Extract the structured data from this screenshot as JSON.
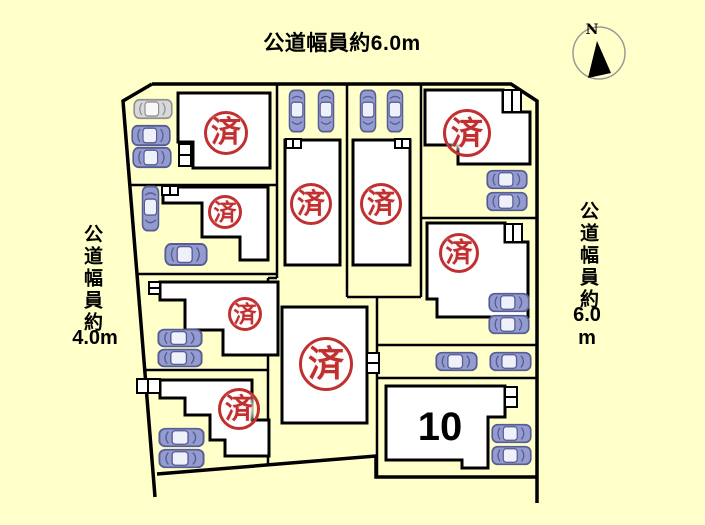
{
  "title": "分譲区画図",
  "roads": {
    "top": {
      "label": "公道幅員約6.0m"
    },
    "left": {
      "label_vertical": "公道幅員約",
      "width_label": "4.0m"
    },
    "right": {
      "label_vertical": "公道幅員約",
      "width_value": "6.0",
      "width_unit": "m"
    }
  },
  "compass": {
    "label": "N"
  },
  "available_lot": {
    "number": "10"
  },
  "sold_stamps": {
    "char": "済",
    "positions": [
      {
        "lot": "1",
        "cx": 226,
        "cy": 133,
        "r": 22
      },
      {
        "lot": "2",
        "cx": 225,
        "cy": 212,
        "r": 17
      },
      {
        "lot": "3",
        "cx": 245,
        "cy": 314,
        "r": 17
      },
      {
        "lot": "4",
        "cx": 239,
        "cy": 409,
        "r": 21
      },
      {
        "lot": "5",
        "cx": 311,
        "cy": 204,
        "r": 21
      },
      {
        "lot": "6",
        "cx": 381,
        "cy": 204,
        "r": 21
      },
      {
        "lot": "7",
        "cx": 326,
        "cy": 364,
        "r": 27
      },
      {
        "lot": "8",
        "cx": 467,
        "cy": 133,
        "r": 24
      },
      {
        "lot": "9",
        "cx": 459,
        "cy": 253,
        "r": 20
      }
    ]
  },
  "cars": [
    {
      "x": 133,
      "y": 98,
      "w": 40,
      "h": 22,
      "dir": "h",
      "variant": "gray"
    },
    {
      "x": 131,
      "y": 124,
      "w": 40,
      "h": 23,
      "dir": "h",
      "variant": "blue"
    },
    {
      "x": 132,
      "y": 146,
      "w": 40,
      "h": 23,
      "dir": "h",
      "variant": "blue"
    },
    {
      "x": 141,
      "y": 185,
      "w": 19,
      "h": 47,
      "dir": "v",
      "variant": "blue"
    },
    {
      "x": 164,
      "y": 242,
      "w": 44,
      "h": 25,
      "dir": "h",
      "variant": "blue"
    },
    {
      "x": 157,
      "y": 328,
      "w": 46,
      "h": 20,
      "dir": "h",
      "variant": "blue"
    },
    {
      "x": 157,
      "y": 348,
      "w": 46,
      "h": 20,
      "dir": "h",
      "variant": "blue"
    },
    {
      "x": 158,
      "y": 427,
      "w": 47,
      "h": 21,
      "dir": "h",
      "variant": "blue"
    },
    {
      "x": 158,
      "y": 448,
      "w": 47,
      "h": 21,
      "dir": "h",
      "variant": "blue"
    },
    {
      "x": 288,
      "y": 89,
      "w": 18,
      "h": 44,
      "dir": "v",
      "variant": "blue"
    },
    {
      "x": 317,
      "y": 89,
      "w": 18,
      "h": 44,
      "dir": "v",
      "variant": "blue"
    },
    {
      "x": 359,
      "y": 89,
      "w": 18,
      "h": 44,
      "dir": "v",
      "variant": "blue"
    },
    {
      "x": 386,
      "y": 89,
      "w": 18,
      "h": 44,
      "dir": "v",
      "variant": "blue"
    },
    {
      "x": 486,
      "y": 169,
      "w": 42,
      "h": 21,
      "dir": "h",
      "variant": "blue"
    },
    {
      "x": 486,
      "y": 191,
      "w": 42,
      "h": 21,
      "dir": "h",
      "variant": "blue"
    },
    {
      "x": 488,
      "y": 292,
      "w": 42,
      "h": 21,
      "dir": "h",
      "variant": "blue"
    },
    {
      "x": 488,
      "y": 314,
      "w": 42,
      "h": 21,
      "dir": "h",
      "variant": "blue"
    },
    {
      "x": 435,
      "y": 351,
      "w": 43,
      "h": 21,
      "dir": "h",
      "variant": "blue"
    },
    {
      "x": 489,
      "y": 351,
      "w": 43,
      "h": 21,
      "dir": "h",
      "variant": "blue"
    },
    {
      "x": 491,
      "y": 423,
      "w": 41,
      "h": 21,
      "dir": "h",
      "variant": "blue"
    },
    {
      "x": 491,
      "y": 445,
      "w": 41,
      "h": 21,
      "dir": "h",
      "variant": "blue"
    }
  ],
  "colors": {
    "page_bg": "#ffffc9",
    "line": "#000000",
    "house_fill": "#ffffff",
    "stamp_red": "#c03030",
    "car_blue": {
      "body": "#949bce",
      "outline": "#565c94",
      "glass": "#eef0fa"
    },
    "car_gray": {
      "body": "#d8d8d8",
      "outline": "#909090",
      "glass": "#f8f8f8"
    }
  }
}
